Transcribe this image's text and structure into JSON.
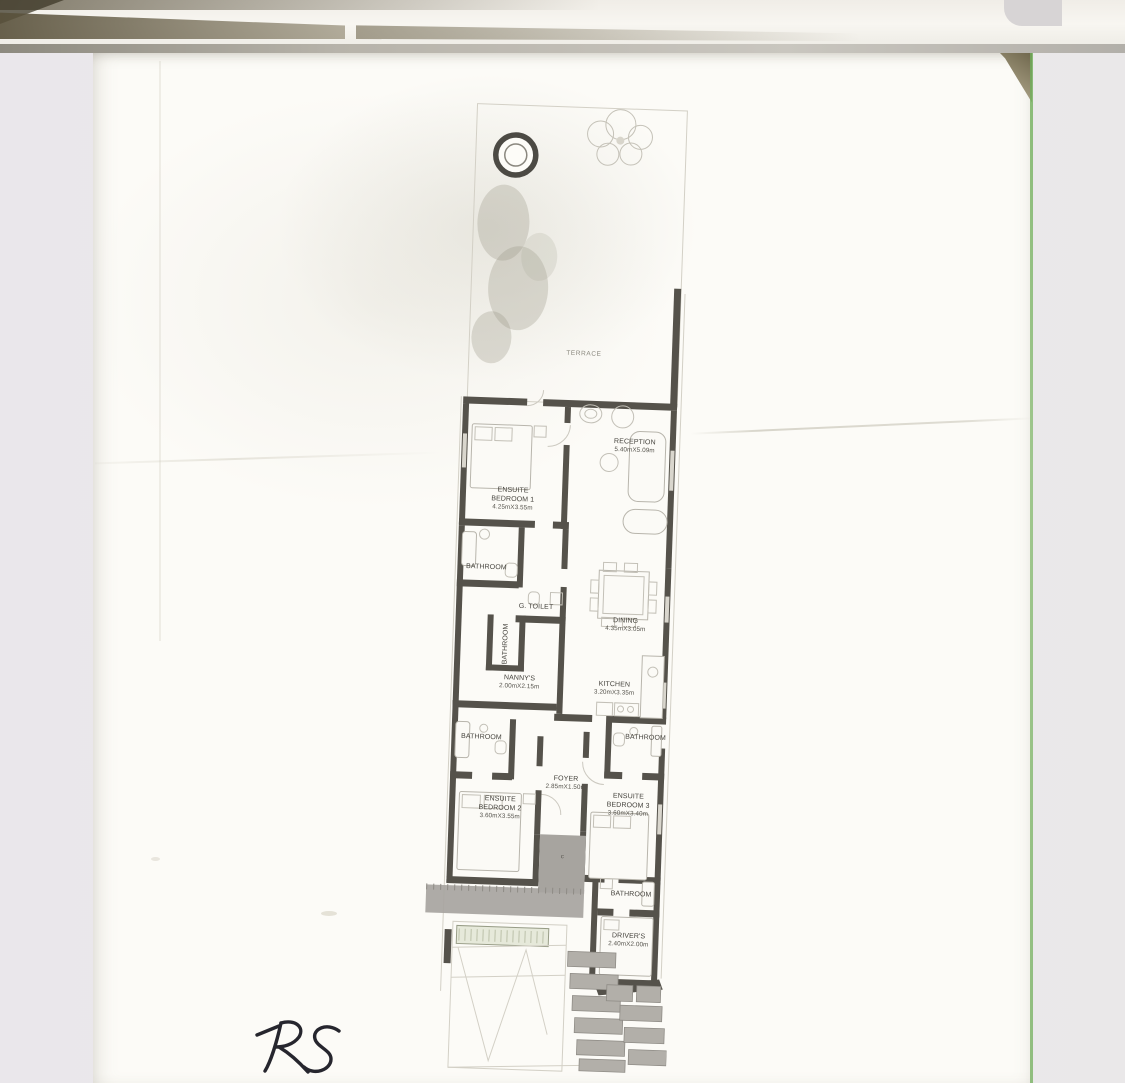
{
  "scan": {
    "handwritten_note": "RS"
  },
  "floor_plan": {
    "rooms": {
      "terrace": {
        "name": "TERRACE",
        "dims": ""
      },
      "reception": {
        "name": "RECEPTION",
        "dims": "5.40mX5.09m"
      },
      "bedroom1": {
        "name": "ENSUITE BEDROOM 1",
        "dims": "4.25mX3.55m"
      },
      "bathroom1": {
        "name": "BATHROOM",
        "dims": ""
      },
      "g_toilet": {
        "name": "G. TOILET",
        "dims": ""
      },
      "bathroom_shaft": {
        "name": "BATHROOM",
        "dims": ""
      },
      "nannys": {
        "name": "NANNY'S",
        "dims": "2.00mX2.15m"
      },
      "dining": {
        "name": "DINING",
        "dims": "4.35mX3.05m"
      },
      "kitchen": {
        "name": "KITCHEN",
        "dims": "3.20mX3.35m"
      },
      "bathroom_left": {
        "name": "BATHROOM",
        "dims": ""
      },
      "bathroom_right": {
        "name": "BATHROOM",
        "dims": ""
      },
      "foyer": {
        "name": "FOYER",
        "dims": "2.85mX1.50m"
      },
      "bedroom2": {
        "name": "ENSUITE BEDROOM 2",
        "dims": "3.60mX3.55m"
      },
      "bedroom3": {
        "name": "ENSUITE BEDROOM 3",
        "dims": "3.60mX3.40m"
      },
      "bathroom_drivers": {
        "name": "BATHROOM",
        "dims": ""
      },
      "drivers": {
        "name": "DRIVER'S",
        "dims": "2.40mX2.00m"
      },
      "column": {
        "name": "c",
        "dims": ""
      }
    }
  },
  "colors": {
    "wall": "#55524b",
    "paper": "#fcfbf7",
    "background": "#ebe8ea",
    "page_edge_green": "#6fae59",
    "fold_shadow": "#6f674d",
    "ink": "#26262e",
    "porch_grey": "#a7a49f",
    "planter_green": "#e6e9da"
  }
}
